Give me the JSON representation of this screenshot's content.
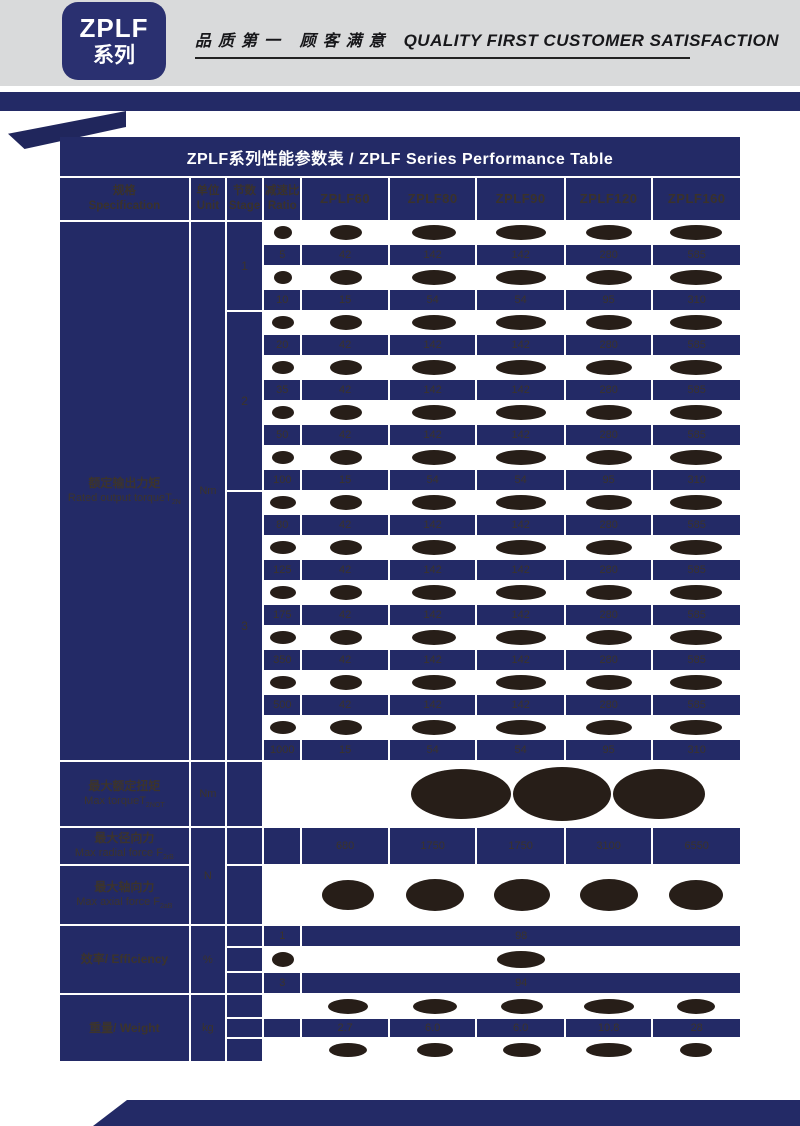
{
  "page": {
    "badge": {
      "line1": "ZPLF",
      "line2": "系列"
    },
    "slogan_cn": "品质第一 顾客满意",
    "slogan_en": "QUALITY FIRST  CUSTOMER SATISFACTION"
  },
  "table": {
    "title": "ZPLF系列性能参数表  /  ZPLF Series Performance Table",
    "header": {
      "spec_cn": "规格",
      "spec_en": "Specification",
      "unit_cn": "单位",
      "unit_en": "Unit",
      "stage_cn": "节数",
      "stage_en": "Stage",
      "ratio_cn": "减速比",
      "ratio_en": "Ratio",
      "models": [
        "ZPLF60",
        "ZPLF80",
        "ZPLF90",
        "ZPLF120",
        "ZPLF160"
      ]
    },
    "rated_torque": {
      "label_cn": "额定输出力矩",
      "label_en": "Rated output torqueT",
      "label_sub": "2N",
      "unit": "Nm",
      "stages": [
        {
          "stage": "1",
          "rows": [
            {
              "redacted": true
            },
            {
              "ratio": "5",
              "values": [
                "42",
                "142",
                "142",
                "280",
                "585"
              ]
            },
            {
              "redacted": true
            },
            {
              "ratio": "10",
              "values": [
                "15",
                "54",
                "54",
                "95",
                "310"
              ]
            }
          ]
        },
        {
          "stage": "2",
          "rows": [
            {
              "redacted": true
            },
            {
              "ratio": "20",
              "values": [
                "42",
                "142",
                "142",
                "280",
                "585"
              ]
            },
            {
              "redacted": true
            },
            {
              "ratio": "35",
              "values": [
                "42",
                "142",
                "142",
                "280",
                "585"
              ]
            },
            {
              "redacted": true
            },
            {
              "ratio": "50",
              "values": [
                "42",
                "142",
                "142",
                "280",
                "585"
              ]
            },
            {
              "redacted": true
            },
            {
              "ratio": "100",
              "values": [
                "15",
                "54",
                "54",
                "95",
                "310"
              ]
            }
          ]
        },
        {
          "stage": "3",
          "rows": [
            {
              "redacted": true
            },
            {
              "ratio": "80",
              "values": [
                "42",
                "142",
                "142",
                "280",
                "585"
              ]
            },
            {
              "redacted": true
            },
            {
              "ratio": "125",
              "values": [
                "42",
                "142",
                "142",
                "280",
                "585"
              ]
            },
            {
              "redacted": true
            },
            {
              "ratio": "175",
              "values": [
                "42",
                "142",
                "142",
                "280",
                "585"
              ]
            },
            {
              "redacted": true
            },
            {
              "ratio": "350",
              "values": [
                "42",
                "142",
                "142",
                "280",
                "585"
              ]
            },
            {
              "redacted": true
            },
            {
              "ratio": "500",
              "values": [
                "42",
                "142",
                "142",
                "280",
                "585"
              ]
            },
            {
              "redacted": true
            },
            {
              "ratio": "1000",
              "values": [
                "15",
                "54",
                "54",
                "95",
                "310"
              ]
            }
          ]
        }
      ]
    },
    "max_torque": {
      "label_cn": "最大额定扭矩",
      "label_en": "Max torqueT",
      "label_sub": "2NOT",
      "unit": "Nm",
      "value_redacted": true
    },
    "forces": {
      "unit": "N",
      "radial": {
        "label_cn": "最大径向力",
        "label_en": "Max radial force F",
        "label_sub": "2rB",
        "values": [
          "680",
          "1750",
          "1750",
          "3100",
          "6550"
        ]
      },
      "axial": {
        "label_cn": "最大轴向力",
        "label_en": "Max axial force F",
        "label_sub": "2aB",
        "redacted": true
      }
    },
    "efficiency": {
      "label": "效率/ Efficiency",
      "unit": "%",
      "rows": [
        {
          "stage": "1",
          "value": "98"
        },
        {
          "redacted": true
        },
        {
          "stage": "3",
          "value": "94"
        }
      ]
    },
    "weight": {
      "label": "重量/ Weight",
      "unit": "kg",
      "rows": [
        {
          "redacted": true
        },
        {
          "values": [
            "2.7",
            "6.0",
            "6.0",
            "10.8",
            "28"
          ]
        },
        {
          "redacted": true
        }
      ]
    }
  }
}
